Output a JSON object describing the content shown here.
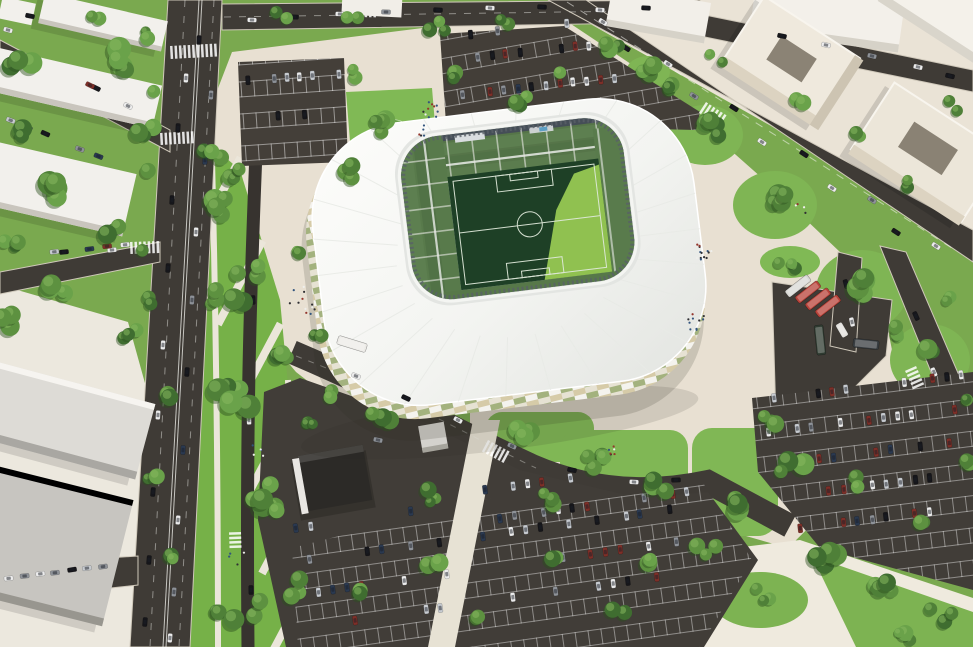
{
  "meta": {
    "description": "Aerial daylight 3D architectural rendering of a white football stadium district with avenue, promenade, parking lots, bus depot and surrounding buildings"
  },
  "palette": {
    "grass": "#7aa94f",
    "lawn": "#76b148",
    "lawn_bright": "#80b955",
    "plaza": "#e8e0d2",
    "plaza_tr": "#eae3d6",
    "plaza_bl": "#ece8de",
    "plaza_br": "#efeade",
    "path": "#ebe6da",
    "asphalt": "#3f3b36",
    "asphalt_lot": "#433e38",
    "lane": "#37332f",
    "roof_white": "#f6f6f3",
    "concourse": "#b5bac0",
    "serration": "#596068",
    "stand_green": "#567549",
    "stand_green2": "#517246",
    "stand_green3": "#5d7f50",
    "stand_back": "#454e57",
    "pitch_dark": "#1e4026",
    "pitch_sun": "#90c150",
    "pitch_line": "#dfe8da",
    "tree_greens": [
      "#3f6d30",
      "#4f8038",
      "#5d9140",
      "#6aa24a"
    ],
    "tree_light": "#86b85e",
    "tree_shadow": "#2c501f",
    "building_white": "#f2f0ec",
    "building_side": "#c9c5bd",
    "building_gray": "#c7c5c0",
    "building_gray2": "#dddbd6",
    "cream_roof": "#efe9dd",
    "cream_front": "#dcd3c1",
    "cream_side": "#cdc4b2",
    "courtyard": "#8b8375",
    "dark_roof": "#2c2a27",
    "line_white": "#f5f5f0"
  },
  "stadium": {
    "ridge_count": 26
  },
  "trees": {
    "clusters": [
      [
        22,
        70,
        3,
        14,
        7,
        11
      ],
      [
        120,
        62,
        4,
        16,
        7,
        12
      ],
      [
        28,
        128,
        3,
        13,
        6,
        10
      ],
      [
        148,
        128,
        3,
        12,
        6,
        10
      ],
      [
        62,
        188,
        4,
        16,
        7,
        12
      ],
      [
        12,
        240,
        3,
        12,
        6,
        10
      ],
      [
        118,
        232,
        3,
        12,
        6,
        10
      ],
      [
        60,
        288,
        4,
        14,
        6,
        11
      ],
      [
        10,
        318,
        3,
        12,
        6,
        10
      ],
      [
        148,
        302,
        2,
        8,
        5,
        8
      ],
      [
        150,
        36,
        2,
        8,
        5,
        8
      ],
      [
        94,
        18,
        2,
        8,
        5,
        8
      ],
      [
        154,
        92,
        1,
        1,
        6,
        8
      ],
      [
        148,
        170,
        1,
        1,
        6,
        8
      ],
      [
        142,
        250,
        1,
        1,
        6,
        8
      ],
      [
        137,
        330,
        1,
        1,
        6,
        8
      ],
      [
        224,
        195,
        5,
        24,
        7,
        12
      ],
      [
        252,
        285,
        6,
        26,
        7,
        12
      ],
      [
        232,
        400,
        6,
        26,
        7,
        12
      ],
      [
        262,
        505,
        6,
        26,
        7,
        12
      ],
      [
        240,
        610,
        5,
        24,
        7,
        12
      ],
      [
        212,
        300,
        3,
        14,
        6,
        9
      ],
      [
        286,
        355,
        3,
        14,
        6,
        9
      ],
      [
        296,
        585,
        3,
        14,
        6,
        10
      ],
      [
        212,
        152,
        3,
        12,
        5,
        8
      ],
      [
        164,
        398,
        2,
        10,
        6,
        9
      ],
      [
        152,
        472,
        2,
        9,
        5,
        8
      ],
      [
        168,
        560,
        2,
        9,
        5,
        8
      ],
      [
        128,
        340,
        2,
        9,
        5,
        8
      ],
      [
        352,
        70,
        2,
        10,
        5,
        8
      ],
      [
        240,
        176,
        3,
        12,
        5,
        9
      ],
      [
        352,
        172,
        3,
        12,
        6,
        9
      ],
      [
        390,
        126,
        4,
        16,
        6,
        10
      ],
      [
        452,
        78,
        2,
        10,
        5,
        8
      ],
      [
        520,
        104,
        3,
        12,
        5,
        9
      ],
      [
        560,
        66,
        2,
        9,
        5,
        8
      ],
      [
        612,
        46,
        3,
        12,
        6,
        9
      ],
      [
        664,
        92,
        3,
        12,
        6,
        9
      ],
      [
        438,
        28,
        3,
        10,
        5,
        8
      ],
      [
        500,
        22,
        2,
        9,
        5,
        8
      ],
      [
        350,
        18,
        2,
        9,
        5,
        8
      ],
      [
        284,
        14,
        2,
        9,
        5,
        8
      ],
      [
        648,
        66,
        3,
        12,
        6,
        10
      ],
      [
        706,
        130,
        4,
        15,
        7,
        11
      ],
      [
        772,
        200,
        4,
        16,
        7,
        11
      ],
      [
        858,
        288,
        4,
        16,
        7,
        12
      ],
      [
        926,
        356,
        3,
        13,
        6,
        10
      ],
      [
        718,
        56,
        2,
        9,
        5,
        8
      ],
      [
        800,
        96,
        2,
        9,
        5,
        8
      ],
      [
        856,
        130,
        2,
        9,
        5,
        8
      ],
      [
        912,
        182,
        2,
        9,
        5,
        8
      ],
      [
        952,
        108,
        2,
        9,
        5,
        8
      ],
      [
        788,
        266,
        3,
        10,
        5,
        8
      ],
      [
        900,
        330,
        3,
        11,
        5,
        9
      ],
      [
        944,
        300,
        2,
        8,
        5,
        7
      ],
      [
        322,
        336,
        2,
        9,
        5,
        8
      ],
      [
        300,
        250,
        2,
        8,
        4,
        7
      ],
      [
        380,
        416,
        3,
        12,
        6,
        10
      ],
      [
        520,
        436,
        3,
        12,
        6,
        10
      ],
      [
        600,
        458,
        4,
        14,
        6,
        11
      ],
      [
        662,
        486,
        3,
        12,
        6,
        10
      ],
      [
        428,
        498,
        3,
        11,
        5,
        9
      ],
      [
        548,
        498,
        3,
        11,
        5,
        9
      ],
      [
        338,
        394,
        2,
        9,
        5,
        8
      ],
      [
        302,
        424,
        3,
        11,
        5,
        9
      ],
      [
        430,
        562,
        2,
        10,
        6,
        9
      ],
      [
        560,
        556,
        2,
        10,
        6,
        9
      ],
      [
        652,
        558,
        2,
        10,
        6,
        9
      ],
      [
        618,
        614,
        2,
        10,
        6,
        9
      ],
      [
        482,
        618,
        2,
        9,
        5,
        8
      ],
      [
        368,
        592,
        2,
        9,
        5,
        8
      ],
      [
        764,
        426,
        3,
        12,
        6,
        10
      ],
      [
        794,
        468,
        4,
        14,
        6,
        11
      ],
      [
        736,
        506,
        4,
        14,
        6,
        11
      ],
      [
        824,
        556,
        4,
        14,
        6,
        11
      ],
      [
        884,
        590,
        4,
        13,
        6,
        10
      ],
      [
        940,
        614,
        3,
        12,
        6,
        10
      ],
      [
        706,
        548,
        3,
        12,
        6,
        10
      ],
      [
        764,
        594,
        3,
        11,
        5,
        9
      ],
      [
        904,
        640,
        3,
        11,
        5,
        9
      ],
      [
        852,
        482,
        2,
        9,
        5,
        8
      ],
      [
        922,
        520,
        2,
        9,
        5,
        8
      ],
      [
        968,
        398,
        2,
        9,
        5,
        8
      ],
      [
        964,
        460,
        2,
        9,
        5,
        8
      ]
    ]
  },
  "cars": {
    "colors": [
      "#ececec",
      "#16161a",
      "#8e9298",
      "#c7cbd0",
      "#2a3950",
      "#7e2f28"
    ],
    "road_cars": [
      [
        199,
        40,
        93,
        1
      ],
      [
        186,
        78,
        93,
        0
      ],
      [
        211,
        95,
        93,
        2
      ],
      [
        178,
        128,
        93,
        1
      ],
      [
        205,
        160,
        93,
        4
      ],
      [
        172,
        200,
        93,
        1
      ],
      [
        196,
        232,
        93,
        0
      ],
      [
        168,
        268,
        94,
        1
      ],
      [
        192,
        300,
        94,
        2
      ],
      [
        163,
        345,
        94,
        0
      ],
      [
        187,
        372,
        94,
        1
      ],
      [
        158,
        415,
        94,
        0
      ],
      [
        183,
        450,
        94,
        4
      ],
      [
        153,
        492,
        95,
        1
      ],
      [
        178,
        520,
        95,
        0
      ],
      [
        149,
        560,
        95,
        1
      ],
      [
        174,
        592,
        95,
        2
      ],
      [
        145,
        622,
        95,
        1
      ],
      [
        170,
        638,
        95,
        0
      ],
      [
        252,
        20,
        2,
        0
      ],
      [
        294,
        17,
        2,
        1
      ],
      [
        340,
        14,
        2,
        0
      ],
      [
        386,
        12,
        2,
        2
      ],
      [
        438,
        10,
        3,
        1
      ],
      [
        490,
        8,
        3,
        0
      ],
      [
        542,
        7,
        3,
        1
      ],
      [
        600,
        10,
        3,
        0
      ],
      [
        646,
        8,
        3,
        1
      ],
      [
        782,
        36,
        12,
        1
      ],
      [
        826,
        45,
        12,
        0
      ],
      [
        872,
        56,
        13,
        2
      ],
      [
        918,
        67,
        13,
        0
      ],
      [
        950,
        76,
        13,
        1
      ],
      [
        603,
        22,
        33,
        0
      ],
      [
        626,
        48,
        33,
        1
      ],
      [
        668,
        64,
        33,
        0
      ],
      [
        694,
        96,
        33,
        2
      ],
      [
        734,
        108,
        33,
        1
      ],
      [
        762,
        142,
        33,
        0
      ],
      [
        804,
        154,
        33,
        1
      ],
      [
        832,
        188,
        33,
        0
      ],
      [
        872,
        200,
        33,
        2
      ],
      [
        896,
        232,
        33,
        1
      ],
      [
        936,
        246,
        33,
        0
      ],
      [
        916,
        316,
        66,
        1
      ],
      [
        934,
        372,
        67,
        0
      ],
      [
        356,
        376,
        22,
        0
      ],
      [
        406,
        398,
        25,
        1
      ],
      [
        458,
        420,
        28,
        0
      ],
      [
        512,
        446,
        25,
        2
      ],
      [
        572,
        470,
        12,
        1
      ],
      [
        634,
        482,
        3,
        0
      ],
      [
        676,
        480,
        -2,
        1
      ],
      [
        740,
        502,
        25,
        0
      ],
      [
        253,
        300,
        88,
        1
      ],
      [
        249,
        420,
        88,
        0
      ],
      [
        251,
        590,
        89,
        1
      ],
      [
        96,
        88,
        26,
        1
      ],
      [
        128,
        106,
        26,
        0
      ],
      [
        64,
        252,
        -6,
        1
      ],
      [
        112,
        250,
        -5,
        0
      ],
      [
        846,
        284,
        75,
        1
      ],
      [
        852,
        322,
        78,
        0
      ],
      [
        378,
        440,
        12,
        2
      ],
      [
        30,
        16,
        12,
        1
      ],
      [
        8,
        30,
        15,
        0
      ]
    ],
    "parking_rows": [
      [
        296,
        528,
        -8,
        9,
        14.5,
        0.5,
        0
      ],
      [
        310,
        560,
        -8,
        26,
        14.5,
        0.6,
        0
      ],
      [
        318,
        592,
        -8,
        26,
        14.5,
        0.55,
        0
      ],
      [
        326,
        624,
        -8,
        24,
        14.5,
        0.5,
        0
      ],
      [
        486,
        520,
        -8,
        15,
        14.5,
        0.55,
        0
      ],
      [
        470,
        492,
        -8,
        10,
        14.5,
        0.4,
        0
      ],
      [
        768,
        432,
        -7,
        14,
        14.5,
        0.6,
        0
      ],
      [
        776,
        464,
        -7,
        14,
        14.5,
        0.6,
        0
      ],
      [
        786,
        496,
        -7,
        13,
        14.5,
        0.55,
        0
      ],
      [
        800,
        528,
        -7,
        11,
        14.5,
        0.5,
        0
      ],
      [
        760,
        400,
        -7,
        15,
        14.5,
        0.6,
        0
      ],
      [
        450,
        60,
        -6,
        12,
        14,
        0.75,
        0
      ],
      [
        462,
        94,
        -6,
        13,
        14,
        0.7,
        0
      ],
      [
        470,
        34,
        -6,
        8,
        14,
        0.45,
        0
      ],
      [
        248,
        80,
        -4,
        8,
        13,
        0.8,
        0
      ],
      [
        252,
        118,
        -4,
        7,
        13,
        0.15,
        0
      ],
      [
        8,
        578,
        -7,
        8,
        16,
        0.85,
        1
      ],
      [
        18,
        256,
        -6,
        7,
        18,
        0.7,
        1
      ],
      [
        36,
        60,
        25,
        6,
        20,
        0.6,
        1
      ],
      [
        10,
        120,
        22,
        6,
        19,
        0.7,
        1
      ]
    ]
  },
  "buses": [
    [
      352,
      344,
      30,
      9,
      17,
      "#ecebe7"
    ],
    [
      798,
      286,
      28,
      8,
      -38,
      "#d9d8d4"
    ],
    [
      808,
      292,
      28,
      8,
      -38,
      "#b8433a"
    ],
    [
      818,
      299,
      28,
      8,
      -38,
      "#b8433a"
    ],
    [
      828,
      306,
      28,
      8,
      -38,
      "#b8433a"
    ],
    [
      820,
      340,
      30,
      9,
      84,
      "#2f3b31"
    ],
    [
      866,
      344,
      26,
      9,
      6,
      "#383d41"
    ],
    [
      842,
      330,
      15,
      7,
      60,
      "#e2e1dd"
    ]
  ],
  "people": {
    "colors": [
      "#2f2f33",
      "#efefec",
      "#93352c",
      "#33557e"
    ],
    "clusters": [
      [
        303,
        300,
        12,
        14
      ],
      [
        433,
        112,
        10,
        10
      ],
      [
        704,
        252,
        14,
        8
      ],
      [
        696,
        322,
        10,
        8
      ],
      [
        612,
        452,
        6,
        8
      ],
      [
        258,
        448,
        5,
        10
      ],
      [
        236,
        560,
        4,
        8
      ],
      [
        420,
        130,
        5,
        6
      ],
      [
        800,
        210,
        4,
        6
      ]
    ]
  },
  "crosswalks": [
    [
      170,
      46,
      -3,
      11,
      13
    ],
    [
      160,
      133,
      -3,
      8,
      12
    ],
    [
      130,
      242,
      -2,
      7,
      12
    ],
    [
      241,
      532,
      88,
      4,
      12
    ],
    [
      488,
      440,
      28,
      6,
      13
    ],
    [
      706,
      102,
      33,
      6,
      13
    ],
    [
      916,
      366,
      66,
      5,
      12
    ],
    [
      356,
      7,
      1,
      5,
      10
    ]
  ]
}
